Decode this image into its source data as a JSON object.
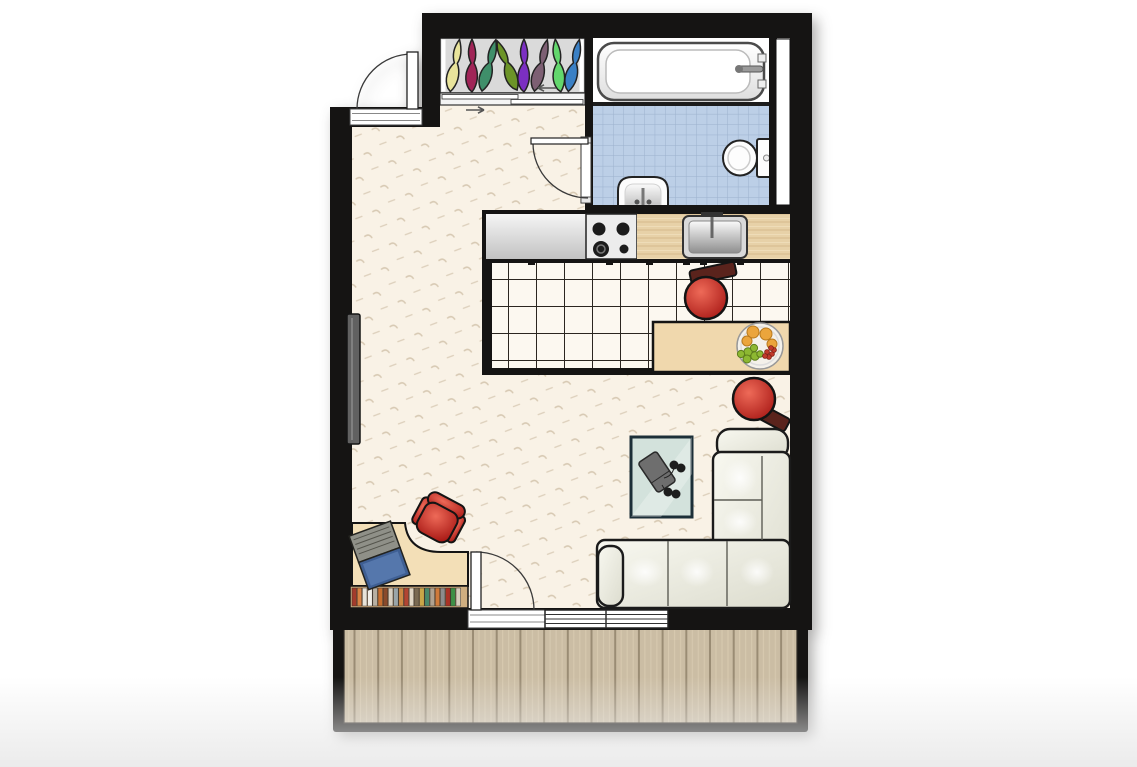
{
  "scene": {
    "kind": "studio-apartment-floor-plan",
    "background": "#ffffff",
    "rooms": [
      "entry-hallway",
      "closet",
      "bathroom",
      "kitchen",
      "living-room",
      "balcony"
    ],
    "furniture": [
      "wardrobe-with-clothes",
      "sliding-closet-doors",
      "bathtub",
      "toilet",
      "pedestal-sink",
      "kitchen-counter",
      "gas-stove",
      "kitchen-sink",
      "dining-table",
      "fruit-bowl",
      "bar-stool",
      "bar-stool",
      "radiator",
      "coffee-table",
      "game-console",
      "gamepads",
      "l-shaped-sofa",
      "desk",
      "laptop",
      "office-chair",
      "book-row",
      "balcony-deck"
    ],
    "doors": [
      "entry-door",
      "bathroom-door",
      "balcony-door"
    ],
    "windows": [
      "living-room-window"
    ]
  },
  "palette": {
    "wall": "#151413",
    "floor": "#f9f2e6",
    "floorMark": "#d8cab4",
    "kitchenTile": "#fcf8f0",
    "kitchenGrid": "#2b2620",
    "bathTile": "#bccfe7",
    "bathGrid": "#9cb1cd",
    "counterWood": "#e7d1a8",
    "counterGray1": "#f5f5f5",
    "counterGray2": "#c2c2c2",
    "stovePanel": "#ececec",
    "tableWood": "#f0d8ad",
    "deskWood": "#f3dfb7",
    "shelfWood": "#cfae80",
    "balconyWood": "#cbbda4",
    "balconyLine": "#9a8c74",
    "closetBg": "#dadada",
    "sofaLight": "#f8f8f0",
    "sofaDark": "#dcdcce",
    "sofaEdge": "#1b1b1b",
    "redLight": "#ee6a58",
    "redDark": "#a51512",
    "stoolBack": "#5a231c",
    "coffeeTable": "#d3e2dc",
    "coffeeEdge": "#1c2f38",
    "radiator": "#616161",
    "laptopScreen": "#3f5f93",
    "laptopKeys": "#8f9088",
    "white": "#ffffff"
  },
  "closet": {
    "hanger_colors": [
      "#e9e49b",
      "#a02457",
      "#3f8f6a",
      "#6c9428",
      "#7b2fc2",
      "#7d5f73",
      "#63d76d",
      "#3a80c5"
    ]
  },
  "books": {
    "colors": [
      "#a33b2b",
      "#d98243",
      "#e8e3d8",
      "#f2efe8",
      "#b8b0a2",
      "#c96f2f",
      "#8a4a2a",
      "#d8cfc0",
      "#9aa5a8",
      "#cc8844",
      "#b24532",
      "#e0d6c4",
      "#7a6a52",
      "#caa648",
      "#49886a",
      "#b0a290",
      "#cf7a3a",
      "#8c8c8c",
      "#aa3326",
      "#3d8f46",
      "#d6cdbd"
    ]
  },
  "fruit": {
    "orange": "#eba53c",
    "grape": "#8db832",
    "grapeEdge": "#5d7d1c",
    "berry": "#c0392b",
    "plate": "#f4f1ea"
  }
}
